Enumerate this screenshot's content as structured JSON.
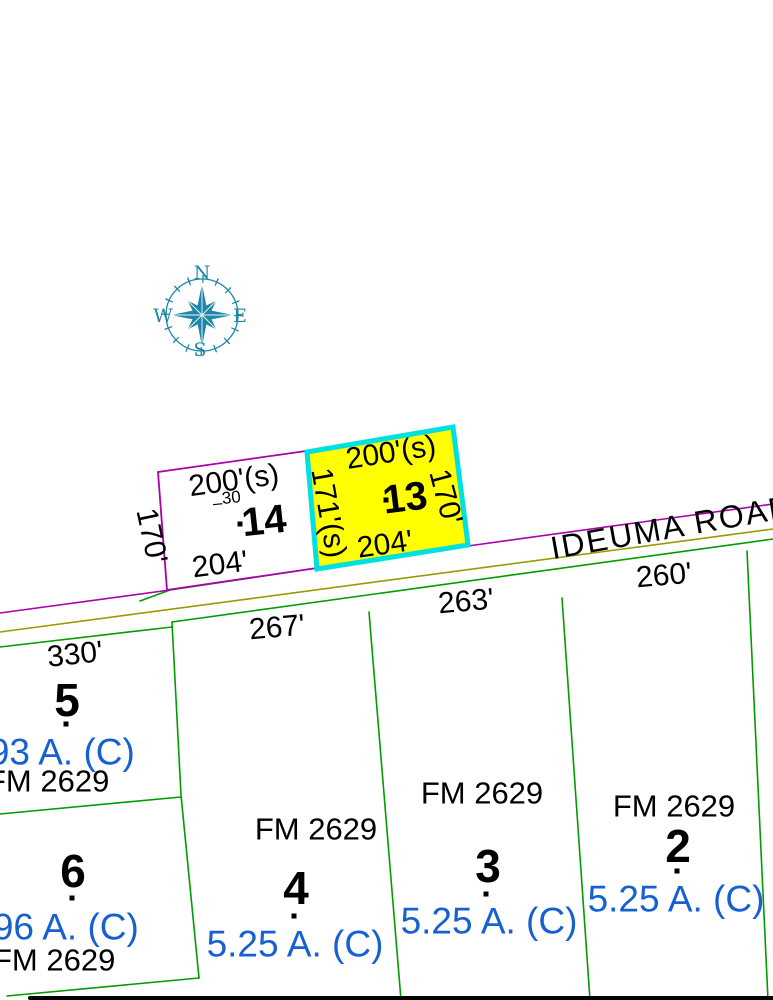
{
  "map": {
    "road_name": "IDEUMA ROAD",
    "compass": {
      "north": "N",
      "east": "E",
      "south": "S",
      "west": "W"
    }
  },
  "colors": {
    "highlight_parcel_fill": "#FFFF00",
    "highlight_parcel_border": "#00E0E0",
    "upper_parcel_line": "#AA00AA",
    "road_center_line": "#9A9A00",
    "lower_parcel_line": "#009C00",
    "acreage_text": "#1660D2",
    "compass_rose": "#1E86A6",
    "label_text": "#000000"
  },
  "upper_lots": {
    "lot14": {
      "number": "14",
      "front": "200'(s)",
      "west": "170'",
      "south": "204'",
      "note_dash": "–",
      "note": "30"
    },
    "lot13": {
      "number": "13",
      "front": "200'(s)",
      "west": "171'(s)",
      "east": "170'",
      "south": "204'"
    }
  },
  "lower_lots": {
    "lot5": {
      "number": "5",
      "front": "330'",
      "acreage": "1.93 A. (C)",
      "road": "FM 2629"
    },
    "lot6": {
      "number": "6",
      "acreage": "1.96 A. (C)",
      "road": "FM 2629"
    },
    "lot4": {
      "number": "4",
      "front": "267'",
      "acreage": "5.25 A. (C)",
      "road": "FM 2629"
    },
    "lot3": {
      "number": "3",
      "front": "263'",
      "acreage": "5.25 A. (C)",
      "road": "FM 2629"
    },
    "lot2": {
      "number": "2",
      "front": "260'",
      "acreage": "5.25 A. (C)",
      "road": "FM 2629"
    }
  }
}
